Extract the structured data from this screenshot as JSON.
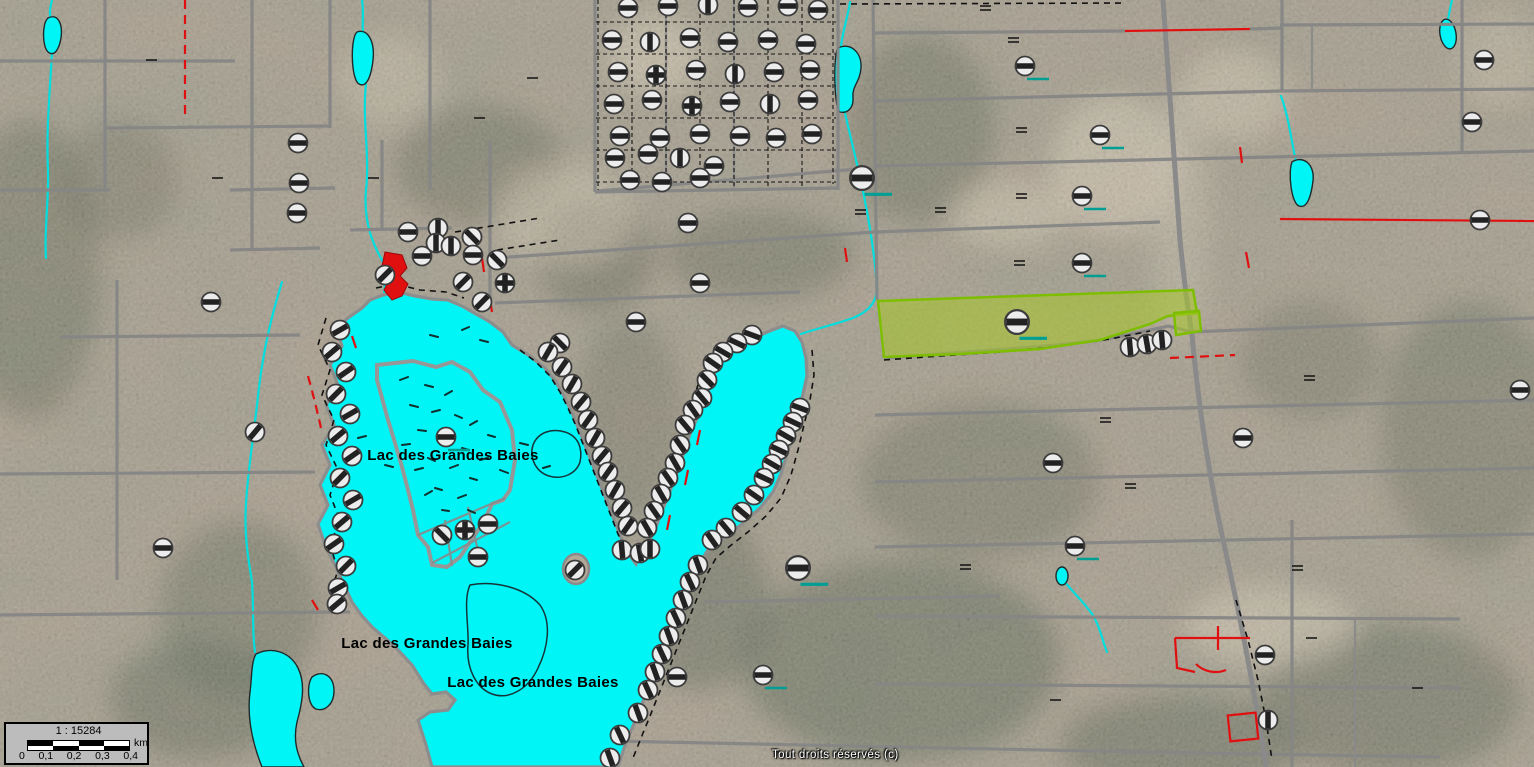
{
  "map": {
    "copyright": "Tout droits réservés (c)",
    "lake_labels": [
      {
        "text": "Lac des Grandes Baies",
        "x": 453,
        "y": 460
      },
      {
        "text": "Lac des Grandes Baies",
        "x": 427,
        "y": 648
      },
      {
        "text": "Lac des Grandes Baies",
        "x": 533,
        "y": 687
      }
    ],
    "colors": {
      "water": "#00f6f6",
      "parcel_fill": "#a8c828",
      "parcel_stroke": "#7ebe00",
      "cadastral_line": "#868686",
      "red_line": "#e01010",
      "marker_fill": "#ececec",
      "marker_bar": "#222222",
      "teal_tie": "#009e93"
    }
  },
  "scalebar": {
    "ratio": "1 : 15284",
    "unit": "km",
    "ticks": [
      "0",
      "0,1",
      "0,2",
      "0,3",
      "0,4"
    ]
  },
  "markers": [
    {
      "x": 628,
      "y": 8,
      "a": 0
    },
    {
      "x": 668,
      "y": 6,
      "a": 0
    },
    {
      "x": 708,
      "y": 5,
      "a": 90
    },
    {
      "x": 748,
      "y": 7,
      "a": 0
    },
    {
      "x": 788,
      "y": 6,
      "a": 0
    },
    {
      "x": 818,
      "y": 10,
      "a": 0
    },
    {
      "x": 612,
      "y": 40,
      "a": 0
    },
    {
      "x": 650,
      "y": 42,
      "a": 90
    },
    {
      "x": 690,
      "y": 38,
      "a": 0
    },
    {
      "x": 728,
      "y": 42,
      "a": 0
    },
    {
      "x": 768,
      "y": 40,
      "a": 0
    },
    {
      "x": 806,
      "y": 44,
      "a": 0
    },
    {
      "x": 618,
      "y": 72,
      "a": 0
    },
    {
      "x": 656,
      "y": 75,
      "a": 0,
      "t": "cross"
    },
    {
      "x": 696,
      "y": 70,
      "a": 0
    },
    {
      "x": 735,
      "y": 74,
      "a": 90
    },
    {
      "x": 774,
      "y": 72,
      "a": 0
    },
    {
      "x": 810,
      "y": 70,
      "a": 0
    },
    {
      "x": 614,
      "y": 104,
      "a": 0
    },
    {
      "x": 652,
      "y": 100,
      "a": 0
    },
    {
      "x": 692,
      "y": 106,
      "a": 0,
      "t": "cross"
    },
    {
      "x": 730,
      "y": 102,
      "a": 0
    },
    {
      "x": 770,
      "y": 104,
      "a": 90
    },
    {
      "x": 808,
      "y": 100,
      "a": 0
    },
    {
      "x": 620,
      "y": 136,
      "a": 0
    },
    {
      "x": 660,
      "y": 138,
      "a": 0
    },
    {
      "x": 700,
      "y": 134,
      "a": 0
    },
    {
      "x": 740,
      "y": 136,
      "a": 0
    },
    {
      "x": 776,
      "y": 138,
      "a": 0
    },
    {
      "x": 812,
      "y": 134,
      "a": 0
    },
    {
      "x": 615,
      "y": 158,
      "a": 0
    },
    {
      "x": 648,
      "y": 154,
      "a": 0
    },
    {
      "x": 680,
      "y": 158,
      "a": 90
    },
    {
      "x": 714,
      "y": 166,
      "a": 0
    },
    {
      "x": 630,
      "y": 180,
      "a": 0
    },
    {
      "x": 662,
      "y": 182,
      "a": 0
    },
    {
      "x": 700,
      "y": 178,
      "a": 0
    },
    {
      "x": 298,
      "y": 143,
      "a": 0
    },
    {
      "x": 299,
      "y": 183,
      "a": 0
    },
    {
      "x": 297,
      "y": 213,
      "a": 0
    },
    {
      "x": 211,
      "y": 302,
      "a": 0
    },
    {
      "x": 255,
      "y": 432,
      "a": -50
    },
    {
      "x": 163,
      "y": 548,
      "a": 0
    },
    {
      "x": 688,
      "y": 223,
      "a": 0
    },
    {
      "x": 700,
      "y": 283,
      "a": 0
    },
    {
      "x": 636,
      "y": 322,
      "a": 0
    },
    {
      "x": 560,
      "y": 343,
      "a": 45
    },
    {
      "x": 385,
      "y": 275,
      "a": -45
    },
    {
      "x": 408,
      "y": 232,
      "a": 0
    },
    {
      "x": 438,
      "y": 228,
      "a": 90
    },
    {
      "x": 422,
      "y": 256,
      "a": 0
    },
    {
      "x": 436,
      "y": 243,
      "a": 90
    },
    {
      "x": 451,
      "y": 246,
      "a": 90
    },
    {
      "x": 472,
      "y": 237,
      "a": 45
    },
    {
      "x": 473,
      "y": 255,
      "a": 0
    },
    {
      "x": 463,
      "y": 282,
      "a": -45
    },
    {
      "x": 482,
      "y": 302,
      "a": -45
    },
    {
      "x": 505,
      "y": 283,
      "a": 0,
      "t": "cross"
    },
    {
      "x": 497,
      "y": 260,
      "a": 45
    },
    {
      "x": 340,
      "y": 330,
      "a": -30
    },
    {
      "x": 332,
      "y": 352,
      "a": -40
    },
    {
      "x": 346,
      "y": 372,
      "a": -35
    },
    {
      "x": 336,
      "y": 394,
      "a": -45
    },
    {
      "x": 350,
      "y": 414,
      "a": -30
    },
    {
      "x": 338,
      "y": 436,
      "a": -40
    },
    {
      "x": 352,
      "y": 456,
      "a": -35
    },
    {
      "x": 340,
      "y": 478,
      "a": -45
    },
    {
      "x": 353,
      "y": 500,
      "a": -30
    },
    {
      "x": 342,
      "y": 522,
      "a": -40
    },
    {
      "x": 334,
      "y": 544,
      "a": -35
    },
    {
      "x": 346,
      "y": 566,
      "a": -45
    },
    {
      "x": 338,
      "y": 588,
      "a": -30
    },
    {
      "x": 337,
      "y": 604,
      "a": -40
    },
    {
      "x": 446,
      "y": 437,
      "a": 0,
      "u": true
    },
    {
      "x": 442,
      "y": 535,
      "a": 45
    },
    {
      "x": 465,
      "y": 530,
      "a": 0,
      "t": "cross"
    },
    {
      "x": 488,
      "y": 524,
      "a": 0
    },
    {
      "x": 478,
      "y": 557,
      "a": 0
    },
    {
      "x": 575,
      "y": 570,
      "a": -45
    },
    {
      "x": 548,
      "y": 352,
      "a": -60
    },
    {
      "x": 562,
      "y": 367,
      "a": -55
    },
    {
      "x": 572,
      "y": 384,
      "a": -60
    },
    {
      "x": 581,
      "y": 402,
      "a": -50
    },
    {
      "x": 588,
      "y": 420,
      "a": -55
    },
    {
      "x": 595,
      "y": 438,
      "a": -60
    },
    {
      "x": 602,
      "y": 456,
      "a": -50
    },
    {
      "x": 608,
      "y": 472,
      "a": -55
    },
    {
      "x": 615,
      "y": 490,
      "a": -60
    },
    {
      "x": 622,
      "y": 508,
      "a": -50
    },
    {
      "x": 628,
      "y": 526,
      "a": -55
    },
    {
      "x": 622,
      "y": 550,
      "a": 85
    },
    {
      "x": 640,
      "y": 553,
      "a": 80
    },
    {
      "x": 650,
      "y": 549,
      "a": 90
    },
    {
      "x": 752,
      "y": 335,
      "a": 20
    },
    {
      "x": 737,
      "y": 343,
      "a": 25
    },
    {
      "x": 723,
      "y": 352,
      "a": 30
    },
    {
      "x": 713,
      "y": 363,
      "a": 35
    },
    {
      "x": 707,
      "y": 380,
      "a": 45
    },
    {
      "x": 702,
      "y": 398,
      "a": 50
    },
    {
      "x": 693,
      "y": 410,
      "a": 55
    },
    {
      "x": 685,
      "y": 425,
      "a": 50
    },
    {
      "x": 680,
      "y": 445,
      "a": 55
    },
    {
      "x": 675,
      "y": 463,
      "a": 60
    },
    {
      "x": 668,
      "y": 478,
      "a": 55
    },
    {
      "x": 661,
      "y": 494,
      "a": 60
    },
    {
      "x": 654,
      "y": 511,
      "a": 55
    },
    {
      "x": 647,
      "y": 528,
      "a": 60
    },
    {
      "x": 800,
      "y": 408,
      "a": 20
    },
    {
      "x": 793,
      "y": 422,
      "a": 25
    },
    {
      "x": 786,
      "y": 436,
      "a": 30
    },
    {
      "x": 779,
      "y": 450,
      "a": 25
    },
    {
      "x": 772,
      "y": 464,
      "a": 30
    },
    {
      "x": 764,
      "y": 478,
      "a": 25
    },
    {
      "x": 754,
      "y": 495,
      "a": 35
    },
    {
      "x": 742,
      "y": 512,
      "a": 40
    },
    {
      "x": 726,
      "y": 528,
      "a": 50
    },
    {
      "x": 712,
      "y": 540,
      "a": 55
    },
    {
      "x": 698,
      "y": 565,
      "a": 70
    },
    {
      "x": 690,
      "y": 582,
      "a": 65
    },
    {
      "x": 683,
      "y": 600,
      "a": 70
    },
    {
      "x": 676,
      "y": 618,
      "a": 65
    },
    {
      "x": 669,
      "y": 636,
      "a": 70
    },
    {
      "x": 662,
      "y": 654,
      "a": 65
    },
    {
      "x": 655,
      "y": 672,
      "a": 70
    },
    {
      "x": 648,
      "y": 690,
      "a": 65
    },
    {
      "x": 638,
      "y": 713,
      "a": 70
    },
    {
      "x": 620,
      "y": 735,
      "a": 65
    },
    {
      "x": 610,
      "y": 758,
      "a": 70
    },
    {
      "x": 798,
      "y": 568,
      "a": 0,
      "s": 1.25,
      "u": true
    },
    {
      "x": 763,
      "y": 675,
      "a": 0,
      "u": true
    },
    {
      "x": 677,
      "y": 677,
      "a": 0
    },
    {
      "x": 862,
      "y": 178,
      "a": 0,
      "s": 1.25,
      "u": true
    },
    {
      "x": 1025,
      "y": 66,
      "a": 0,
      "u": true
    },
    {
      "x": 1100,
      "y": 135,
      "a": 0,
      "u": true
    },
    {
      "x": 1082,
      "y": 196,
      "a": 0,
      "u": true
    },
    {
      "x": 1082,
      "y": 263,
      "a": 0,
      "u": true
    },
    {
      "x": 1017,
      "y": 322,
      "a": 0,
      "s": 1.25,
      "u": true
    },
    {
      "x": 1130,
      "y": 347,
      "a": 85
    },
    {
      "x": 1147,
      "y": 344,
      "a": 80
    },
    {
      "x": 1162,
      "y": 340,
      "a": 85
    },
    {
      "x": 1053,
      "y": 463,
      "a": 0
    },
    {
      "x": 1075,
      "y": 546,
      "a": 0,
      "u": true
    },
    {
      "x": 1243,
      "y": 438,
      "a": 0
    },
    {
      "x": 1265,
      "y": 655,
      "a": 0
    },
    {
      "x": 1268,
      "y": 720,
      "a": 90
    },
    {
      "x": 1520,
      "y": 390,
      "a": 0
    },
    {
      "x": 1484,
      "y": 60,
      "a": 0
    },
    {
      "x": 1472,
      "y": 122,
      "a": 0
    },
    {
      "x": 1480,
      "y": 220,
      "a": 0
    }
  ]
}
